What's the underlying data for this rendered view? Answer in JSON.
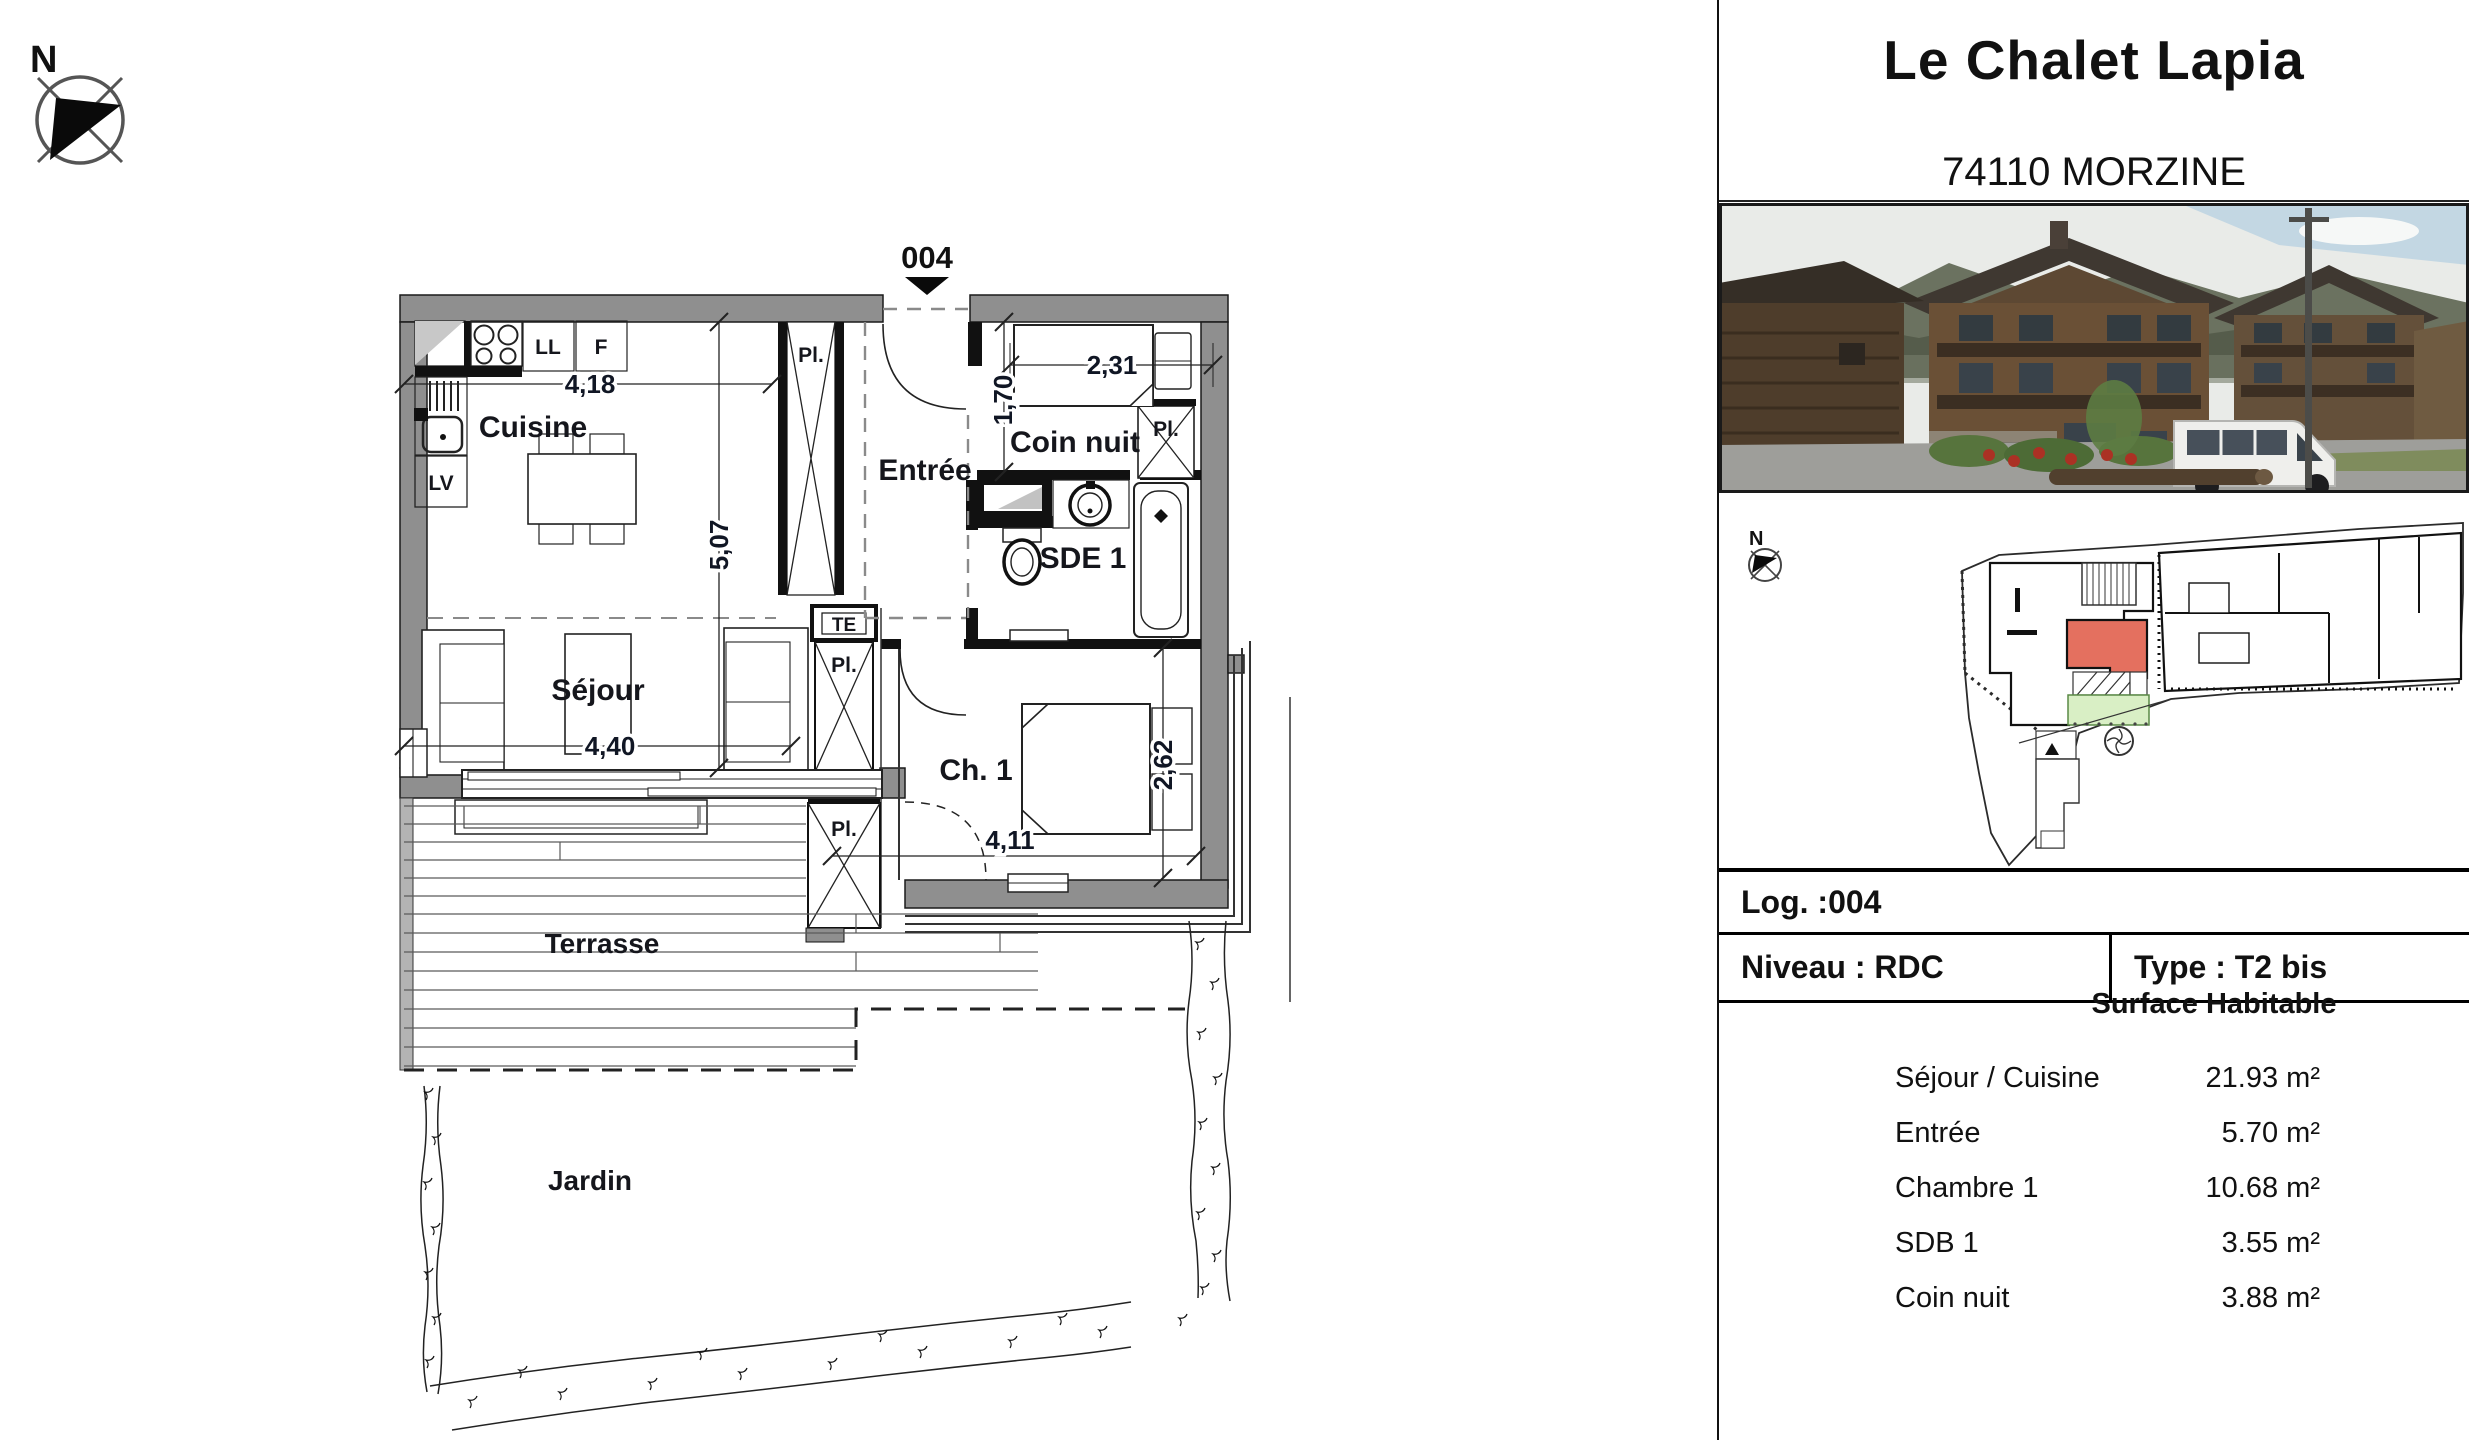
{
  "compass": {
    "label": "N"
  },
  "floor_plan": {
    "unit_marker": "004",
    "rooms": {
      "cuisine": "Cuisine",
      "sejour": "Séjour",
      "entree": "Entrée",
      "coin_nuit": "Coin nuit",
      "sde1": "SDE 1",
      "chambre1": "Ch. 1",
      "terrasse": "Terrasse",
      "jardin": "Jardin"
    },
    "fixtures": {
      "lave_linge": "LL",
      "frigo": "F",
      "lave_vaisselle": "LV",
      "tableau_electrique": "TE",
      "placard": "Pl."
    },
    "dimensions": {
      "cuisine_largeur": "4,18",
      "sejour_hauteur": "5,07",
      "sejour_largeur": "4,40",
      "coin_nuit_largeur": "2,31",
      "coin_nuit_profondeur": "1,70",
      "chambre_profondeur": "2,62",
      "chambre_largeur": "4,11"
    }
  },
  "info_panel": {
    "title": "Le Chalet Lapia",
    "subtitle": "74110 MORZINE",
    "site_plan": {
      "north_label": "N"
    },
    "log_row": "Log. :004",
    "niveau_row": "Niveau : RDC",
    "type_row": "Type : T2 bis",
    "surface_table": {
      "title": "Surface Habitable",
      "rows": [
        {
          "label": "Séjour / Cuisine",
          "value": "21.93 m²"
        },
        {
          "label": "Entrée",
          "value": "5.70 m²"
        },
        {
          "label": "Chambre 1",
          "value": "10.68 m²"
        },
        {
          "label": "SDB 1",
          "value": "3.55 m²"
        },
        {
          "label": "Coin nuit",
          "value": "3.88 m²"
        }
      ]
    }
  },
  "colors": {
    "unit_highlight": "#e4705f",
    "terrace_highlight": "#d9efc5",
    "wall_gray": "#8f8f8f"
  }
}
